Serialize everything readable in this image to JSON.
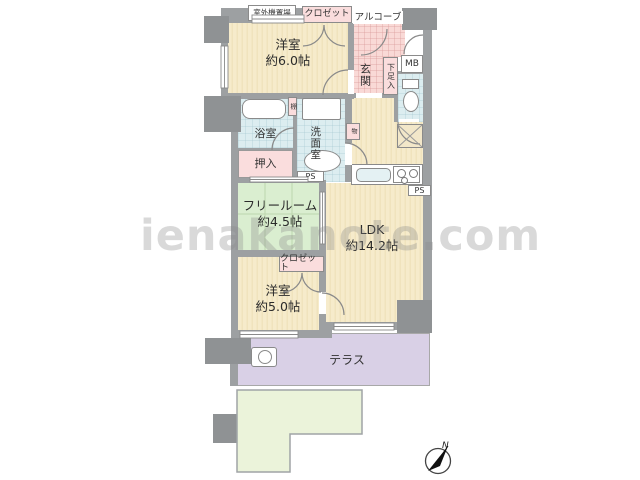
{
  "watermark": "ienakanote.com",
  "palette": {
    "floor_beige": "#f6ebcb",
    "pink": "#f9d9d6",
    "water_blue": "#dcedf0",
    "free_room_green": "#daeed0",
    "terrace_purple": "#d9d0e6",
    "garden_green": "#ebf3da",
    "wall_gray": "#9da0a2"
  },
  "rooms": {
    "bedroom_6": {
      "name": "洋室",
      "area": "約6.0帖"
    },
    "free_room": {
      "name": "フリールーム",
      "area": "約4.5帖"
    },
    "ldk": {
      "name": "LDK",
      "area": "約14.2帖"
    },
    "bedroom_5": {
      "name": "洋室",
      "area": "約5.0帖"
    },
    "bathroom": {
      "name": "浴室"
    },
    "washroom": {
      "name": "洗面室"
    },
    "entrance": {
      "name": "玄関"
    },
    "terrace": {
      "name": "テラス"
    },
    "garden": {
      "name": "専用庭"
    }
  },
  "labels": {
    "outdoor_unit": "室外機置場",
    "closet_top": "クロゼット",
    "alcove": "アルコーブ",
    "shoe_cabinet": "下足入",
    "meter_box": "MB",
    "shelf": "棚",
    "oshiire": "押入",
    "ps_washroom": "PS",
    "ps_kitchen": "PS",
    "closet_bottom": "クロゼット",
    "storage": "物"
  },
  "compass": {
    "north": "N"
  }
}
